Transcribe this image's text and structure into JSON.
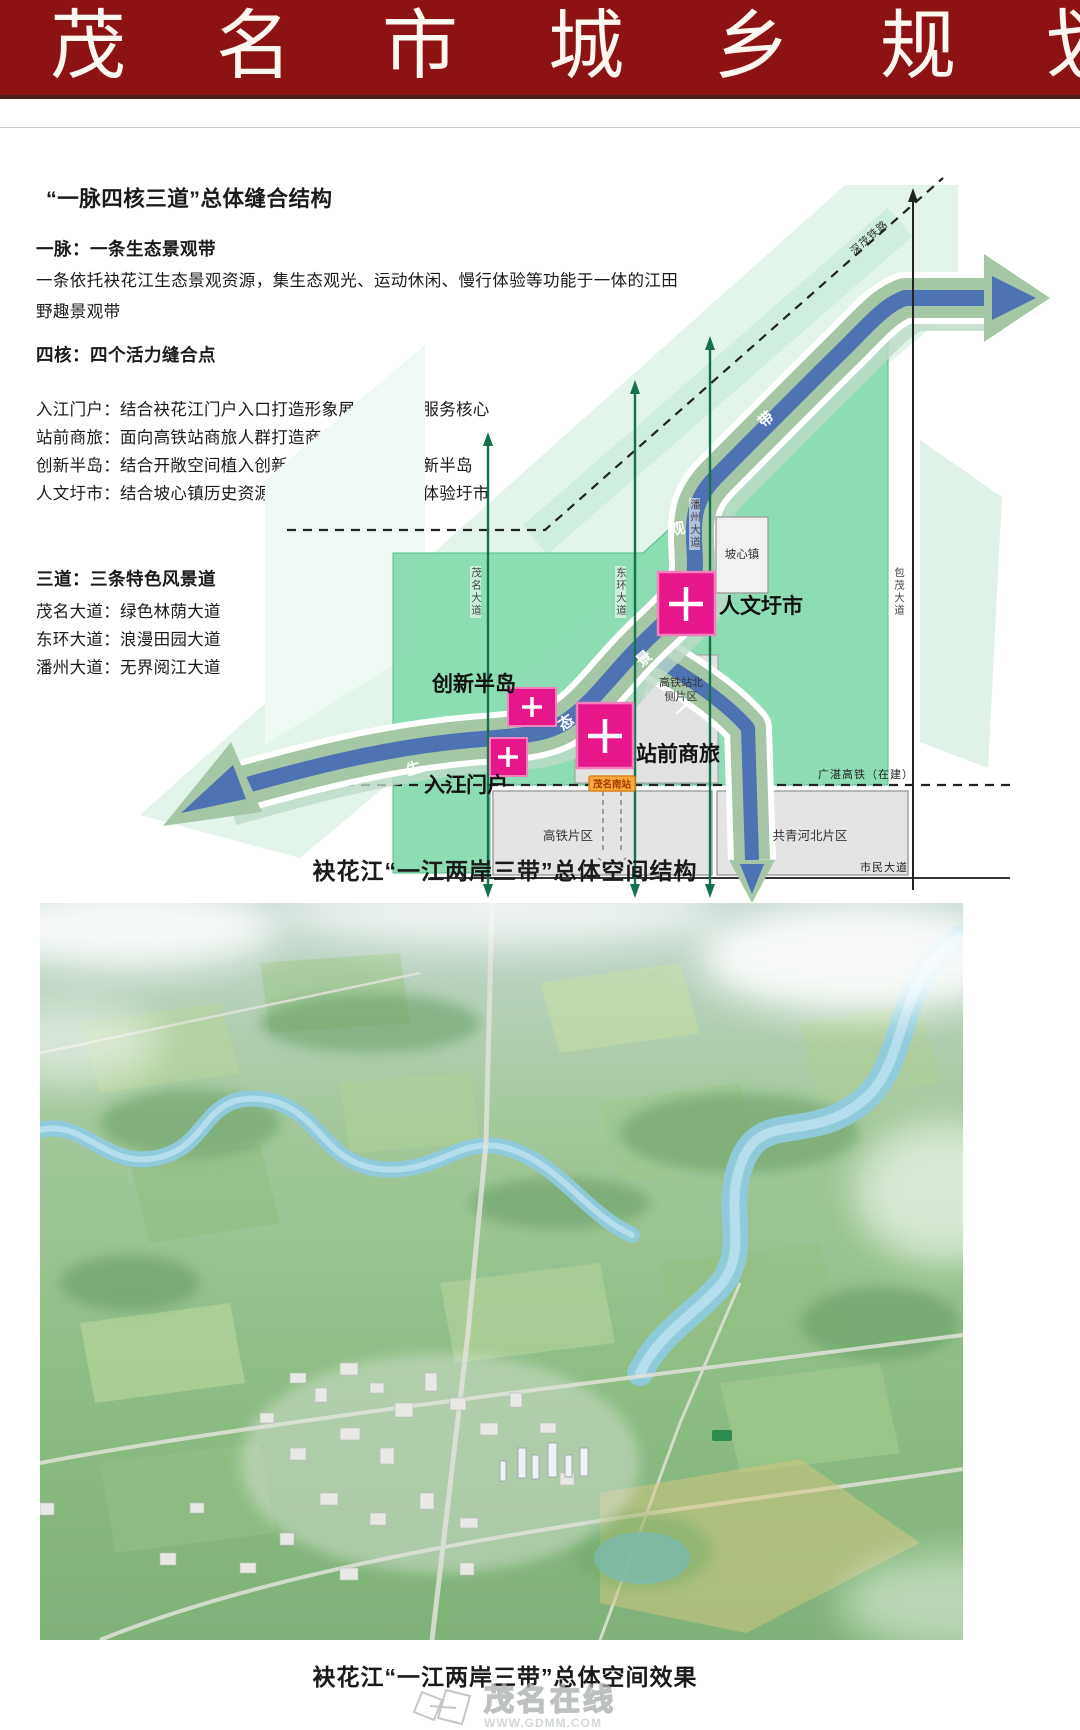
{
  "banner": {
    "title": "茂名市城乡规划"
  },
  "left_panel": {
    "section_title": "“一脉四核三道”总体缝合结构",
    "group1": {
      "heading": "一脉：一条生态景观带",
      "para": "一条依托袂花江生态景观资源，集生态观光、运动休闲、慢行体验等功能于一体的江田野趣景观带"
    },
    "group2": {
      "heading": "四核：四个活力缝合点",
      "lines": [
        "入江门户：结合袂花江门户入口打造形象展示与综合服务核心",
        "站前商旅：面向高铁站商旅人群打造商旅服务核心",
        "创新半岛：结合开敞空间植入创新创意功能，打造创新半岛",
        "人文圩市：结合坡心镇历史资源与人气基础打造人文体验圩市"
      ]
    },
    "group3": {
      "heading": "三道：三条特色风景道",
      "lines": [
        "茂名大道：绿色林荫大道",
        "东环大道：浪漫田园大道",
        "潘州大道：无界阅江大道"
      ]
    }
  },
  "diagram": {
    "nodes": [
      {
        "label": "入江门户"
      },
      {
        "label": "创新半岛"
      },
      {
        "label": "站前商旅"
      },
      {
        "label": "人文圩市"
      }
    ],
    "belt_chars": [
      "生",
      "态",
      "景",
      "观",
      "带"
    ],
    "roads": {
      "maoming": "茂名大道",
      "donghuan": "东环大道",
      "panzhou": "潘州大道",
      "baomao": "包茂大道",
      "shimin": "市民大道"
    },
    "rails": {
      "shenmao": "深茂铁路",
      "guangzhan": "广湛高铁（在建）"
    },
    "areas": {
      "poxin": "坡心镇",
      "hsr_north_1": "高铁站北",
      "hsr_north_2": "侧片区",
      "hsr_block": "高铁片区",
      "gongqing": "共青河北片区"
    },
    "station_badge": "茂名南站",
    "colors": {
      "banner_red": "#8d1212",
      "belt_blue": "#4d73b3",
      "belt_sage": "#a6c7a6",
      "area_green": "#87dcb0",
      "node_pink": "#e6178a",
      "road_green_line": "#15714b"
    }
  },
  "captions": {
    "structure": "袂花江“一江两岸三带”总体空间结构",
    "effect": "袂花江“一江两岸三带”总体空间效果"
  },
  "watermark": {
    "name": "茂名在线",
    "url": "WWW.GDMM.COM"
  }
}
